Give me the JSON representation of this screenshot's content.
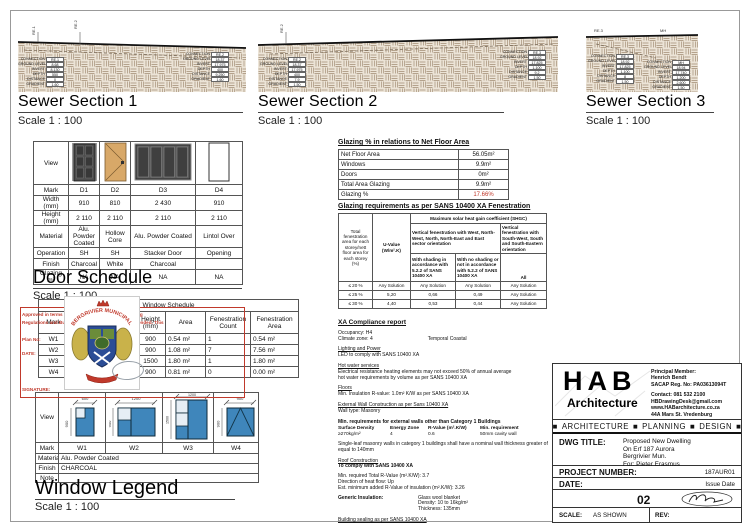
{
  "sewer_sections": [
    {
      "title": "Sewer Section 1",
      "scale": "Scale  1 : 100",
      "top_labels": [
        "RE.1",
        "RE.2"
      ],
      "left_table": [
        [
          "CONNECTION",
          "RE.1"
        ],
        [
          "GROUND LEVEL",
          "8.68"
        ],
        [
          "INVERT",
          "8.130"
        ],
        [
          "DEPTH",
          "550"
        ],
        [
          "DISTANCE",
          "0"
        ],
        [
          "GRADIENT",
          "1.60"
        ]
      ],
      "right_table": [
        [
          "CONNECTION",
          "RE.2"
        ],
        [
          "GROUND LEVEL",
          "18.37"
        ],
        [
          "INVERT",
          "17.975"
        ],
        [
          "DEPTH",
          "400"
        ],
        [
          "DISTANCE",
          "9.250"
        ],
        [
          "GRADIENT",
          "1.60"
        ]
      ]
    },
    {
      "title": "Sewer Section 2",
      "scale": "Scale  1 : 100",
      "top_labels": [
        "RE.2"
      ],
      "left_table": [
        [
          "CONNECTION",
          "RE.2"
        ],
        [
          "GROUND LEVEL",
          "18.37"
        ],
        [
          "INVERT",
          "17.975"
        ],
        [
          "DEPTH",
          "400"
        ],
        [
          "DISTANCE",
          "7.9"
        ],
        [
          "GRADIENT",
          "1.50"
        ]
      ],
      "right_table": [
        [
          "CONNECTION",
          "RE.3"
        ],
        [
          "GROUND LEVEL",
          "18.92"
        ],
        [
          "INVERT",
          "17.825"
        ],
        [
          "DEPTH",
          "1.100"
        ],
        [
          "DISTANCE",
          "9.2"
        ],
        [
          "GRADIENT",
          "1.50"
        ]
      ]
    },
    {
      "title": "Sewer Section 3",
      "scale": "Scale  1 : 100",
      "top_labels": [
        "RE.3",
        "MH"
      ],
      "left_table": [
        [
          "CONNECTION",
          "RE.3"
        ],
        [
          "GROUND LEVEL",
          "18.92"
        ],
        [
          "INVERT",
          "17.825"
        ],
        [
          "DEPTH",
          "1.100"
        ],
        [
          "DISTANCE",
          "8"
        ],
        [
          "GRADIENT",
          "1.50"
        ]
      ],
      "right_table": [
        [
          "CONNECTION",
          "MH"
        ],
        [
          "GROUND LEVEL",
          "18.94"
        ],
        [
          "INVERT",
          "17.740"
        ],
        [
          "DEPTH",
          "1.200"
        ],
        [
          "DISTANCE",
          "2.600"
        ],
        [
          "GRADIENT",
          "1.50"
        ]
      ]
    }
  ],
  "door_schedule": {
    "title": "Door Schedule",
    "scale": "Scale  1 : 100",
    "row_labels": [
      "View",
      "Mark",
      "Width (mm)",
      "Height (mm)",
      "Material",
      "Operation",
      "Finish",
      "Glazing m²"
    ],
    "cols": [
      {
        "mark": "D1",
        "width": "910",
        "height": "2 110",
        "material": "Alu. Powder Coated",
        "operation": "SH",
        "finish": "Charcoal",
        "glazing": "NA"
      },
      {
        "mark": "D2",
        "width": "810",
        "height": "2 110",
        "material": "Hollow Core",
        "operation": "SH",
        "finish": "White",
        "glazing": "NA"
      },
      {
        "mark": "D3",
        "width": "2 430",
        "height": "2 110",
        "material": "Alu. Powder Coated",
        "operation": "Stacker Door",
        "finish": "Charcoal",
        "glazing": "NA"
      },
      {
        "mark": "D4",
        "width": "910",
        "height": "2 110",
        "material": "Lintol Over",
        "operation": "Opening",
        "finish": "",
        "glazing": "NA"
      }
    ]
  },
  "window_schedule": {
    "title": "Window Schedule",
    "headers": [
      "Mark",
      "Head Height (mm)",
      "Width (mm)",
      "Height (mm)",
      "Area",
      "Fenestration Count",
      "Fenestration Area"
    ],
    "rows": [
      [
        "W1",
        "2100",
        "600",
        "900",
        "0.54 m²",
        "1",
        "0.54 m²"
      ],
      [
        "W2",
        "2100",
        "1200",
        "900",
        "1.08 m²",
        "7",
        "7.56 m²"
      ],
      [
        "W3",
        "2100",
        "1200",
        "1500",
        "1.80 m²",
        "1",
        "1.80 m²"
      ],
      [
        "W4",
        "450",
        "900",
        "900",
        "0.81 m²",
        "0",
        "0.00 m²"
      ]
    ]
  },
  "window_legend": {
    "title": "Window Legend",
    "scale": "Scale  1 : 100",
    "row_labels": [
      "View",
      "Mark",
      "Material",
      "Finish",
      "Note"
    ],
    "marks": [
      "W1",
      "W2",
      "W3",
      "W4"
    ],
    "material": "Alu. Powder Coated",
    "finish": "CHARCOAL",
    "note": "",
    "views": [
      {
        "w": "600",
        "h": "900"
      },
      {
        "w": "1200",
        "h": "900"
      },
      {
        "w": "1200",
        "h": "1500"
      },
      {
        "w": "900",
        "h": "900"
      }
    ]
  },
  "glazing_pct": {
    "title": "Glazing % in relations to Net Floor Area",
    "rows": [
      [
        "Net Floor Area",
        "56.05m²"
      ],
      [
        "Windows",
        "9.9m²"
      ],
      [
        "Doors",
        "0m²"
      ],
      [
        "Total Area Glazing",
        "9.9m²"
      ],
      [
        "Glazing %",
        "17.66%"
      ]
    ]
  },
  "glazing_req": {
    "title": "Glazing requirements as per SANS 10400 XA Fenestration",
    "col1": "Total fenestration area for each storey/nett floor area for each storey (%)",
    "col2": "U-Value (W/m².K)",
    "shgc": "Maximum solar heat gain coefficient (SHGC)",
    "west": "Vertical fenestration with West, North- West, North, North-East and East sector orientation",
    "south": "Vertical fenestration with South-West, South and South-Eastern orientation",
    "sub1": "With shading in accordance with 5.2.2 of SANS 10400 XA",
    "sub2": "With no shading or not in accordance with 5.2.2 of SANS 10400 XA",
    "sub3": "All",
    "rows": [
      [
        "≤ 20 %",
        "Any Solution",
        "Any Solution",
        "Any Solution",
        "Any Solution"
      ],
      [
        "≤ 25 %",
        "5,20",
        "0,66",
        "0,49",
        "Any Solution"
      ],
      [
        "≤ 30 %",
        "4,40",
        "0,53",
        "0,44",
        "Any Solution"
      ]
    ]
  },
  "xa": {
    "title": "XA Compliance report",
    "occupancy": "Occupancy: H4",
    "climate": "Climate zone: 4",
    "climate2": "Temporal Coastal",
    "h_lighting": "Lighting and Power",
    "lighting": "LED to comply with SANS 10400 XA",
    "h_hotwater": "Hot water services",
    "hotwater1": "Electrical resistance heating elements may not exceed 50% of annual average",
    "hotwater2": "hot water requirements by volume as per SANS 10400 XA",
    "h_floors": "Floors",
    "floors": "Min. Insulation R-value: 1.0m² K/W as per SANS 10400 XA",
    "h_walls": "External Wall Construction as per Sans 10400 XA",
    "walls": "Wall type: Masonry",
    "b_minreq": "Min. requirements for external walls other than Category 1 Buildings",
    "wall_headers": [
      "Surface Density",
      "Energy Zone",
      "R-Value (m².K/W)",
      "Min. requirement"
    ],
    "wall_values": [
      "≥270kg/m²",
      "4",
      "0.6",
      "50mm cavity wall"
    ],
    "note": "Single-leaf masonry walls in category 1 buildings shall have a nominal wall thickness greater of equal to 140mm",
    "h_roof": "Roof Construction",
    "roof_b": "To comply with SANS 10400 XA",
    "roof1": "Min. required Total R-Value (m².K/W): 3.7",
    "roof2": "Direction of heat flow: Up",
    "roof3": "Est. minimum added R-Value of insulation (m².K/W): 3.26",
    "b_generic": "Generic Insulation:",
    "gen1": "Glass wool blanket",
    "gen2": "Density: 10 to 16kg/m²",
    "gen3": "Thickness: 135mm",
    "sealing": "Building sealing as per SANS 10400 XA"
  },
  "stamp": {
    "arc_text": "BERGRIVIER MUNICIPALITY",
    "line1": "Approved in terms of Section 7 of the National Building",
    "line2": "Regulations and Building Standards Act, 1977, as amended. This",
    "line3": "Plan No:",
    "line4": "DATE:",
    "signature": "SIGNATURE:"
  },
  "title_block": {
    "logo": "HAB",
    "logo_sub": "Architecture",
    "principal_label": "Principal Member:",
    "principal_name": "Henrich Bendt",
    "principal_reg": "SACAP Reg. No: PA03613094T",
    "contact1": "Contact: 081 532 2100",
    "contact2": "HBDrawingDesk@gmail.com",
    "contact3": "www.HABarchitecture.co.za",
    "contact4": "44A Mars St. Vredenburg",
    "services": [
      "ARCHITECTURE",
      "PLANNING",
      "DESIGN"
    ],
    "dwg_label": "DWG TITLE:",
    "dwg_lines": [
      "Proposed New Dwelling",
      "On Erf 187 Aurora",
      "Bergrivier Mun.",
      "For: Pieter Erasmus"
    ],
    "project_label": "PROJECT NUMBER:",
    "project_number": "187AUR01",
    "date_label": "DATE:",
    "date_value": "Issue Date",
    "sheet_number": "02",
    "scale_label": "SCALE:",
    "scale_value": "AS SHOWN",
    "rev_label": "REV:"
  }
}
